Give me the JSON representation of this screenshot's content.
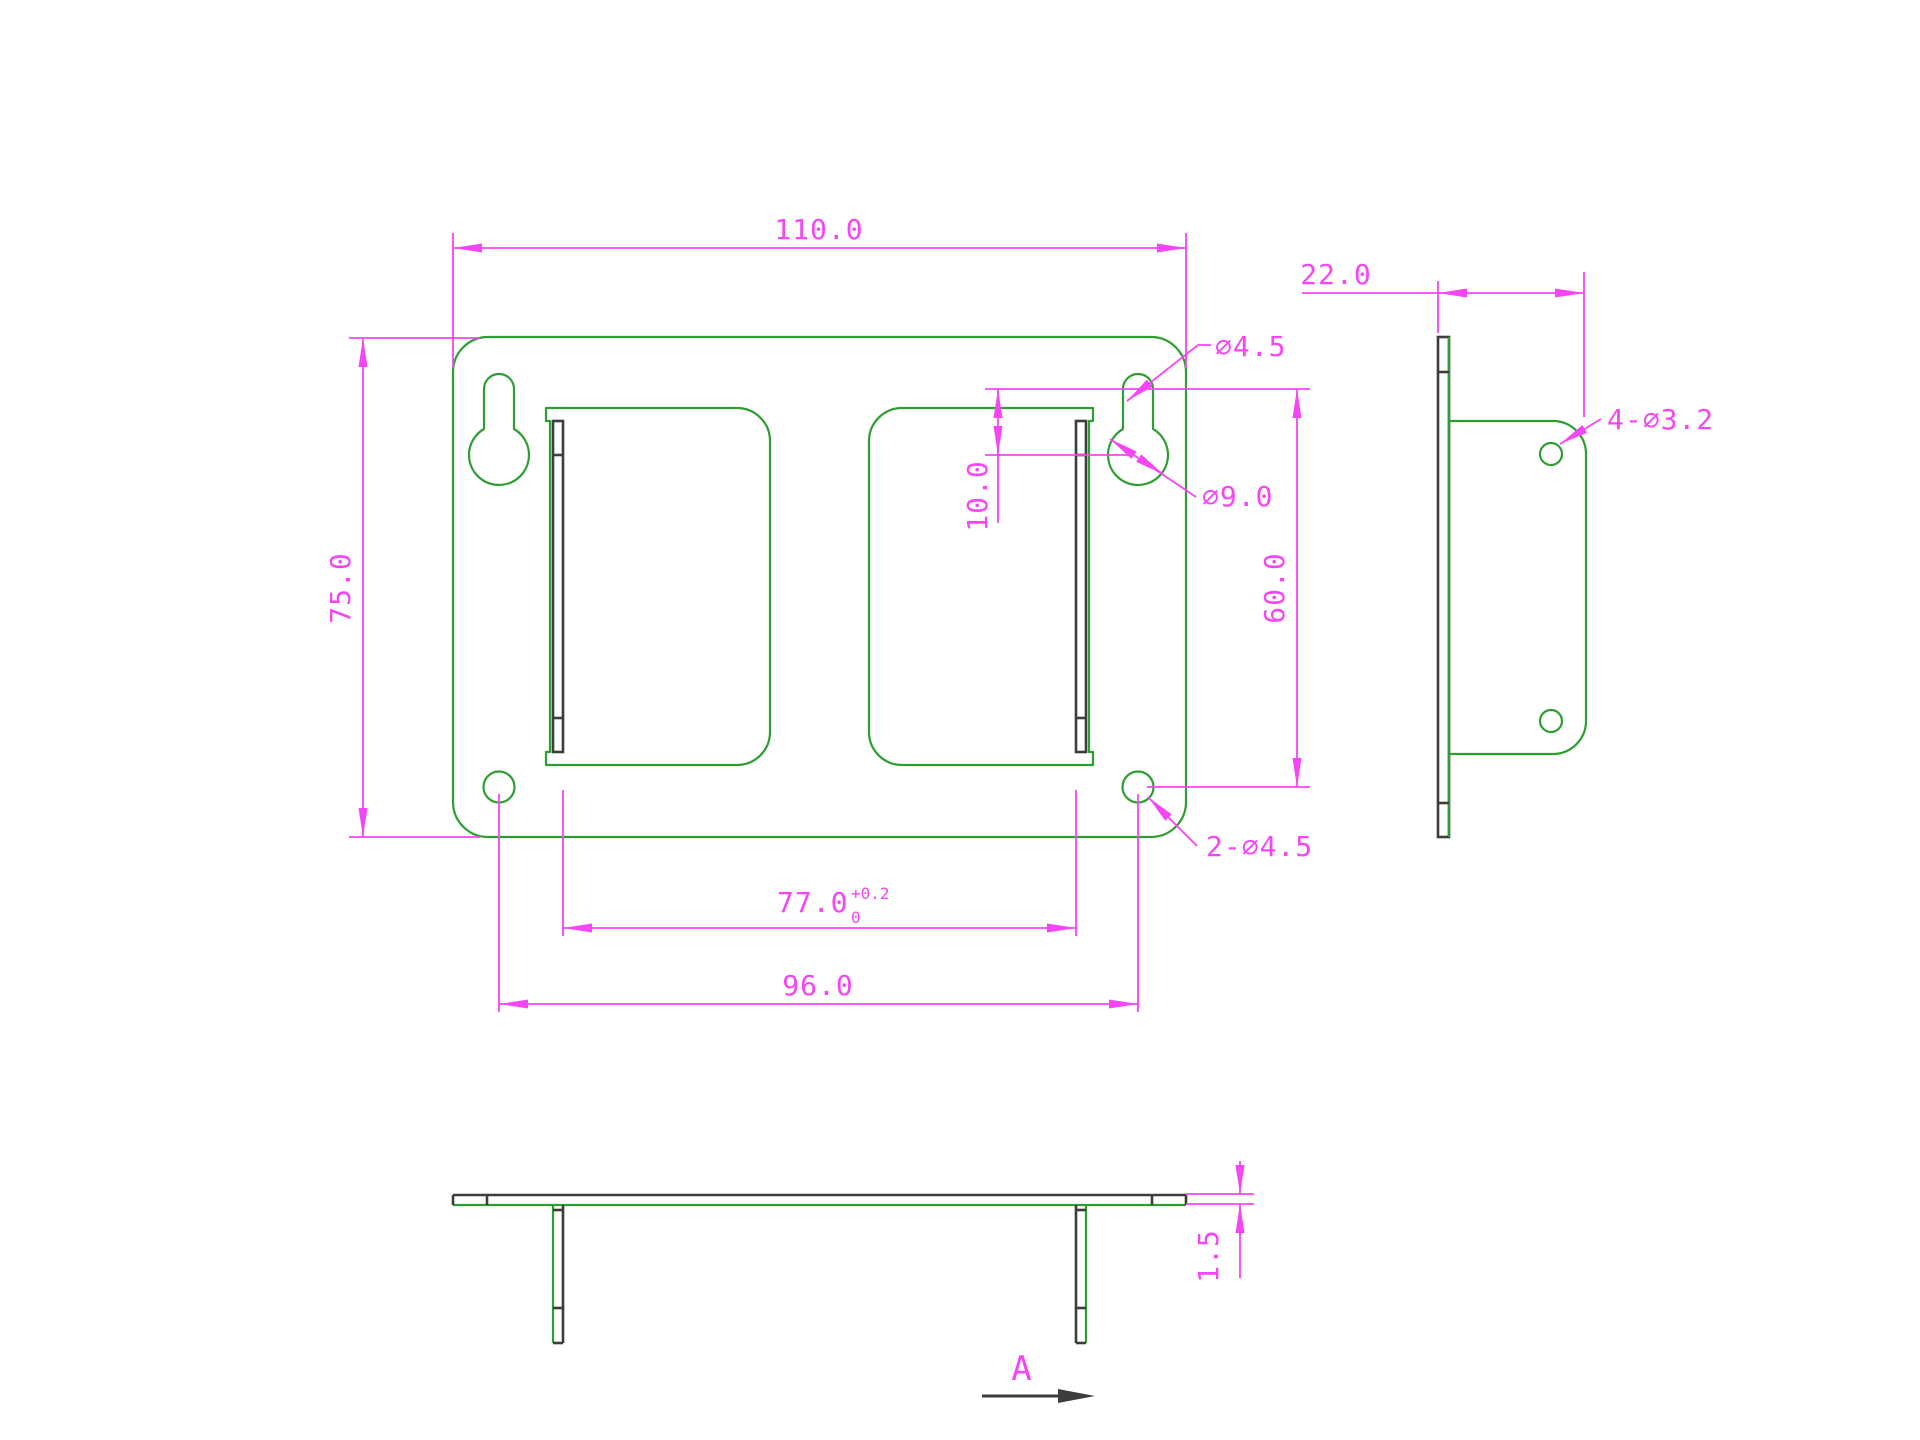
{
  "drawing": {
    "colors": {
      "geometry_green": "#2e9e33",
      "dimension_magenta": "#f545f5",
      "edge_dark": "#3d3d3d",
      "background": "#ffffff"
    },
    "front_view": {
      "width": "110.0",
      "height": "75.0",
      "keyhole_offset": "10.0",
      "keyhole_to_hole": "60.0",
      "hole_span": "96.0",
      "flange_gap": "77.0",
      "flange_gap_tol_upper": "+0.2",
      "flange_gap_tol_lower": "0",
      "keyhole_slot_dia": "∅4.5",
      "keyhole_circle_dia": "∅9.0",
      "bottom_holes": "2-∅4.5"
    },
    "side_view": {
      "depth": "22.0",
      "flange_holes": "4-∅3.2"
    },
    "bottom_view": {
      "thickness": "1.5",
      "section_label": "A"
    }
  }
}
